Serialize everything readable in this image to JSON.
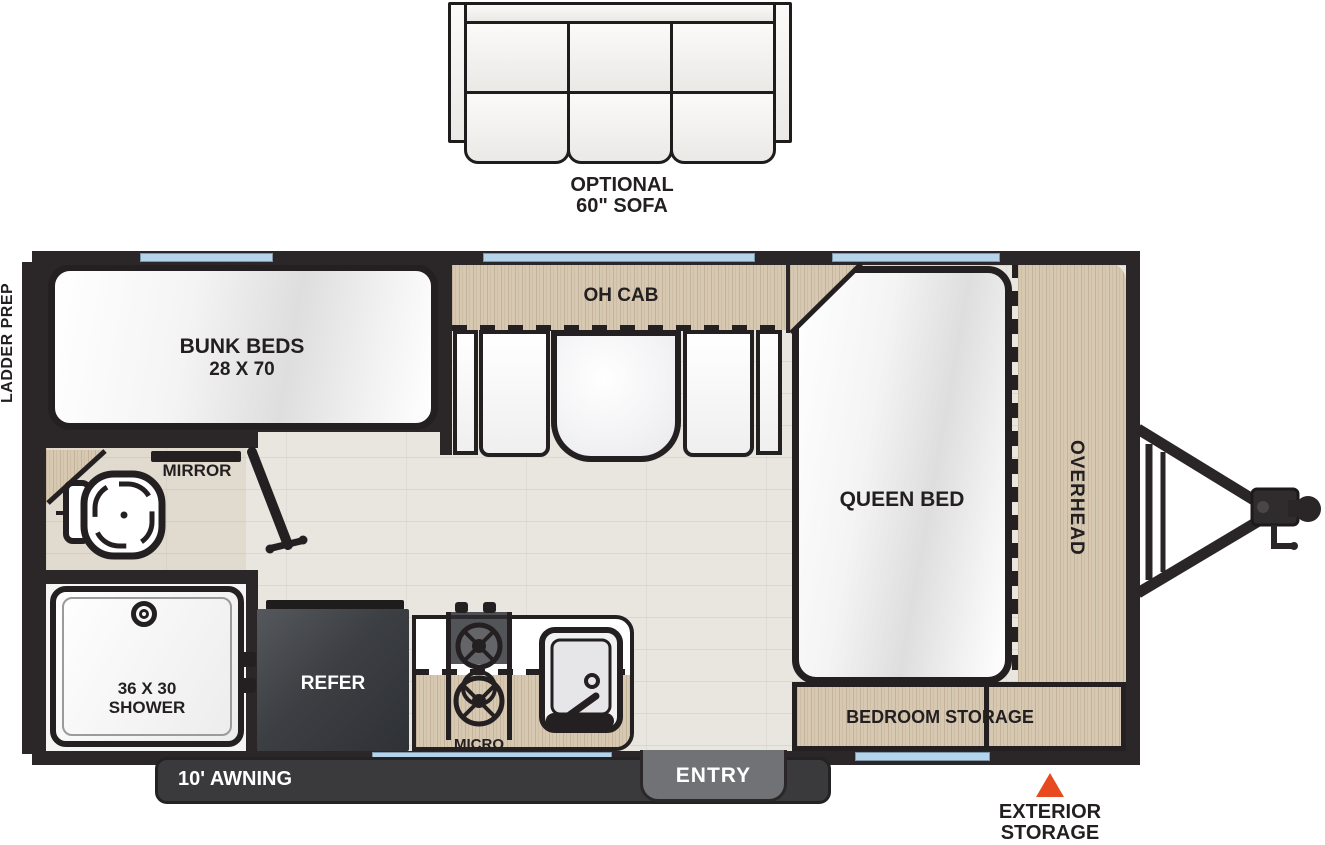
{
  "colors": {
    "wall": "#2b2728",
    "outline": "#242021",
    "wood": "#d6c8b1",
    "floor": "#e9e6e0",
    "window_blue": "#b5d3ea",
    "refer_gray": "#43464a",
    "awning_dark": "#3a3a3c",
    "entry_gray": "#717275",
    "accent_orange": "#e84a20",
    "text_dark": "#231f20",
    "text_light": "#ffffff"
  },
  "sofa": {
    "label_line1": "OPTIONAL",
    "label_line2": "60\" SOFA"
  },
  "rooms": {
    "bunk_line1": "BUNK BEDS",
    "bunk_line2": "28 X 70",
    "oh_cab": "OH CAB",
    "mirror": "MIRROR",
    "queen": "QUEEN BED",
    "overhead": "OVERHEAD",
    "shower_line1": "36 X 30",
    "shower_line2": "SHOWER",
    "refer": "REFER",
    "micro": "MICRO",
    "bedroom_storage": "BEDROOM STORAGE"
  },
  "exterior": {
    "ladder_prep": "LADDER PREP",
    "awning": "10' AWNING",
    "entry": "ENTRY",
    "storage_line1": "EXTERIOR",
    "storage_line2": "STORAGE"
  }
}
